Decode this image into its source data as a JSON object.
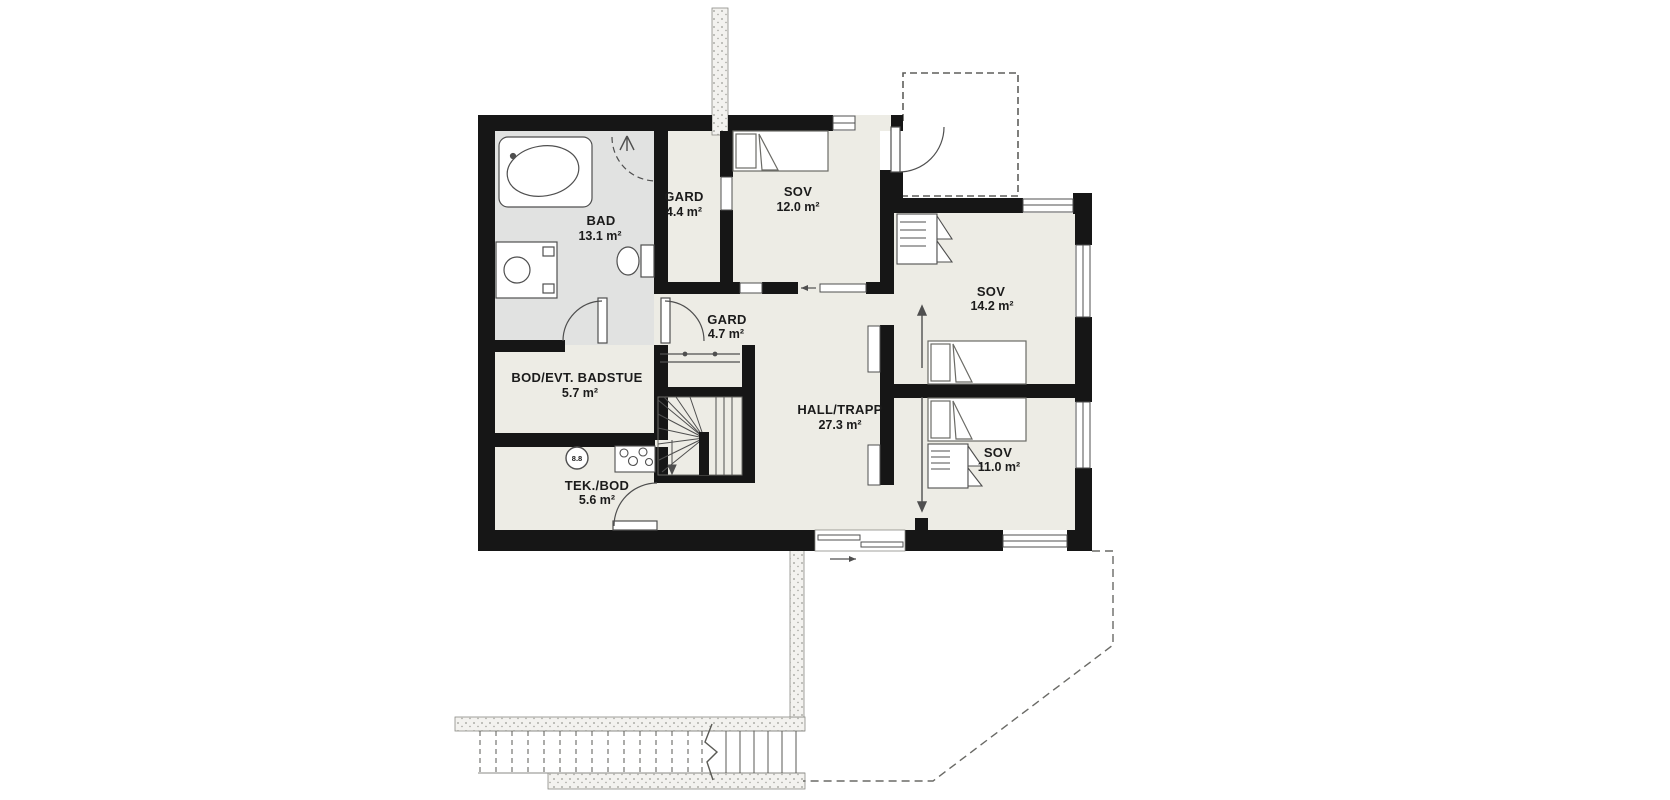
{
  "floor_plan": {
    "rooms": [
      {
        "name": "BAD",
        "area": "13.1 m²"
      },
      {
        "name": "GARD",
        "area": "4.4 m²"
      },
      {
        "name": "SOV",
        "area": "12.0 m²"
      },
      {
        "name": "SOV",
        "area": "14.2 m²"
      },
      {
        "name": "GARD",
        "area": "4.7 m²"
      },
      {
        "name": "HALL/TRAPP",
        "area": "27.3 m²"
      },
      {
        "name": "BOD/EVT. BADSTUE",
        "area": "5.7 m²"
      },
      {
        "name": "TEK./BOD",
        "area": "5.6 m²"
      },
      {
        "name": "SOV",
        "area": "11.0 m²"
      }
    ],
    "marker_label": "8.8",
    "colors": {
      "wall": "#161616",
      "room_fill": "#edece5",
      "bath_fill": "#e1e2e1",
      "line": "#4f4f4f",
      "background": "#ffffff"
    }
  }
}
